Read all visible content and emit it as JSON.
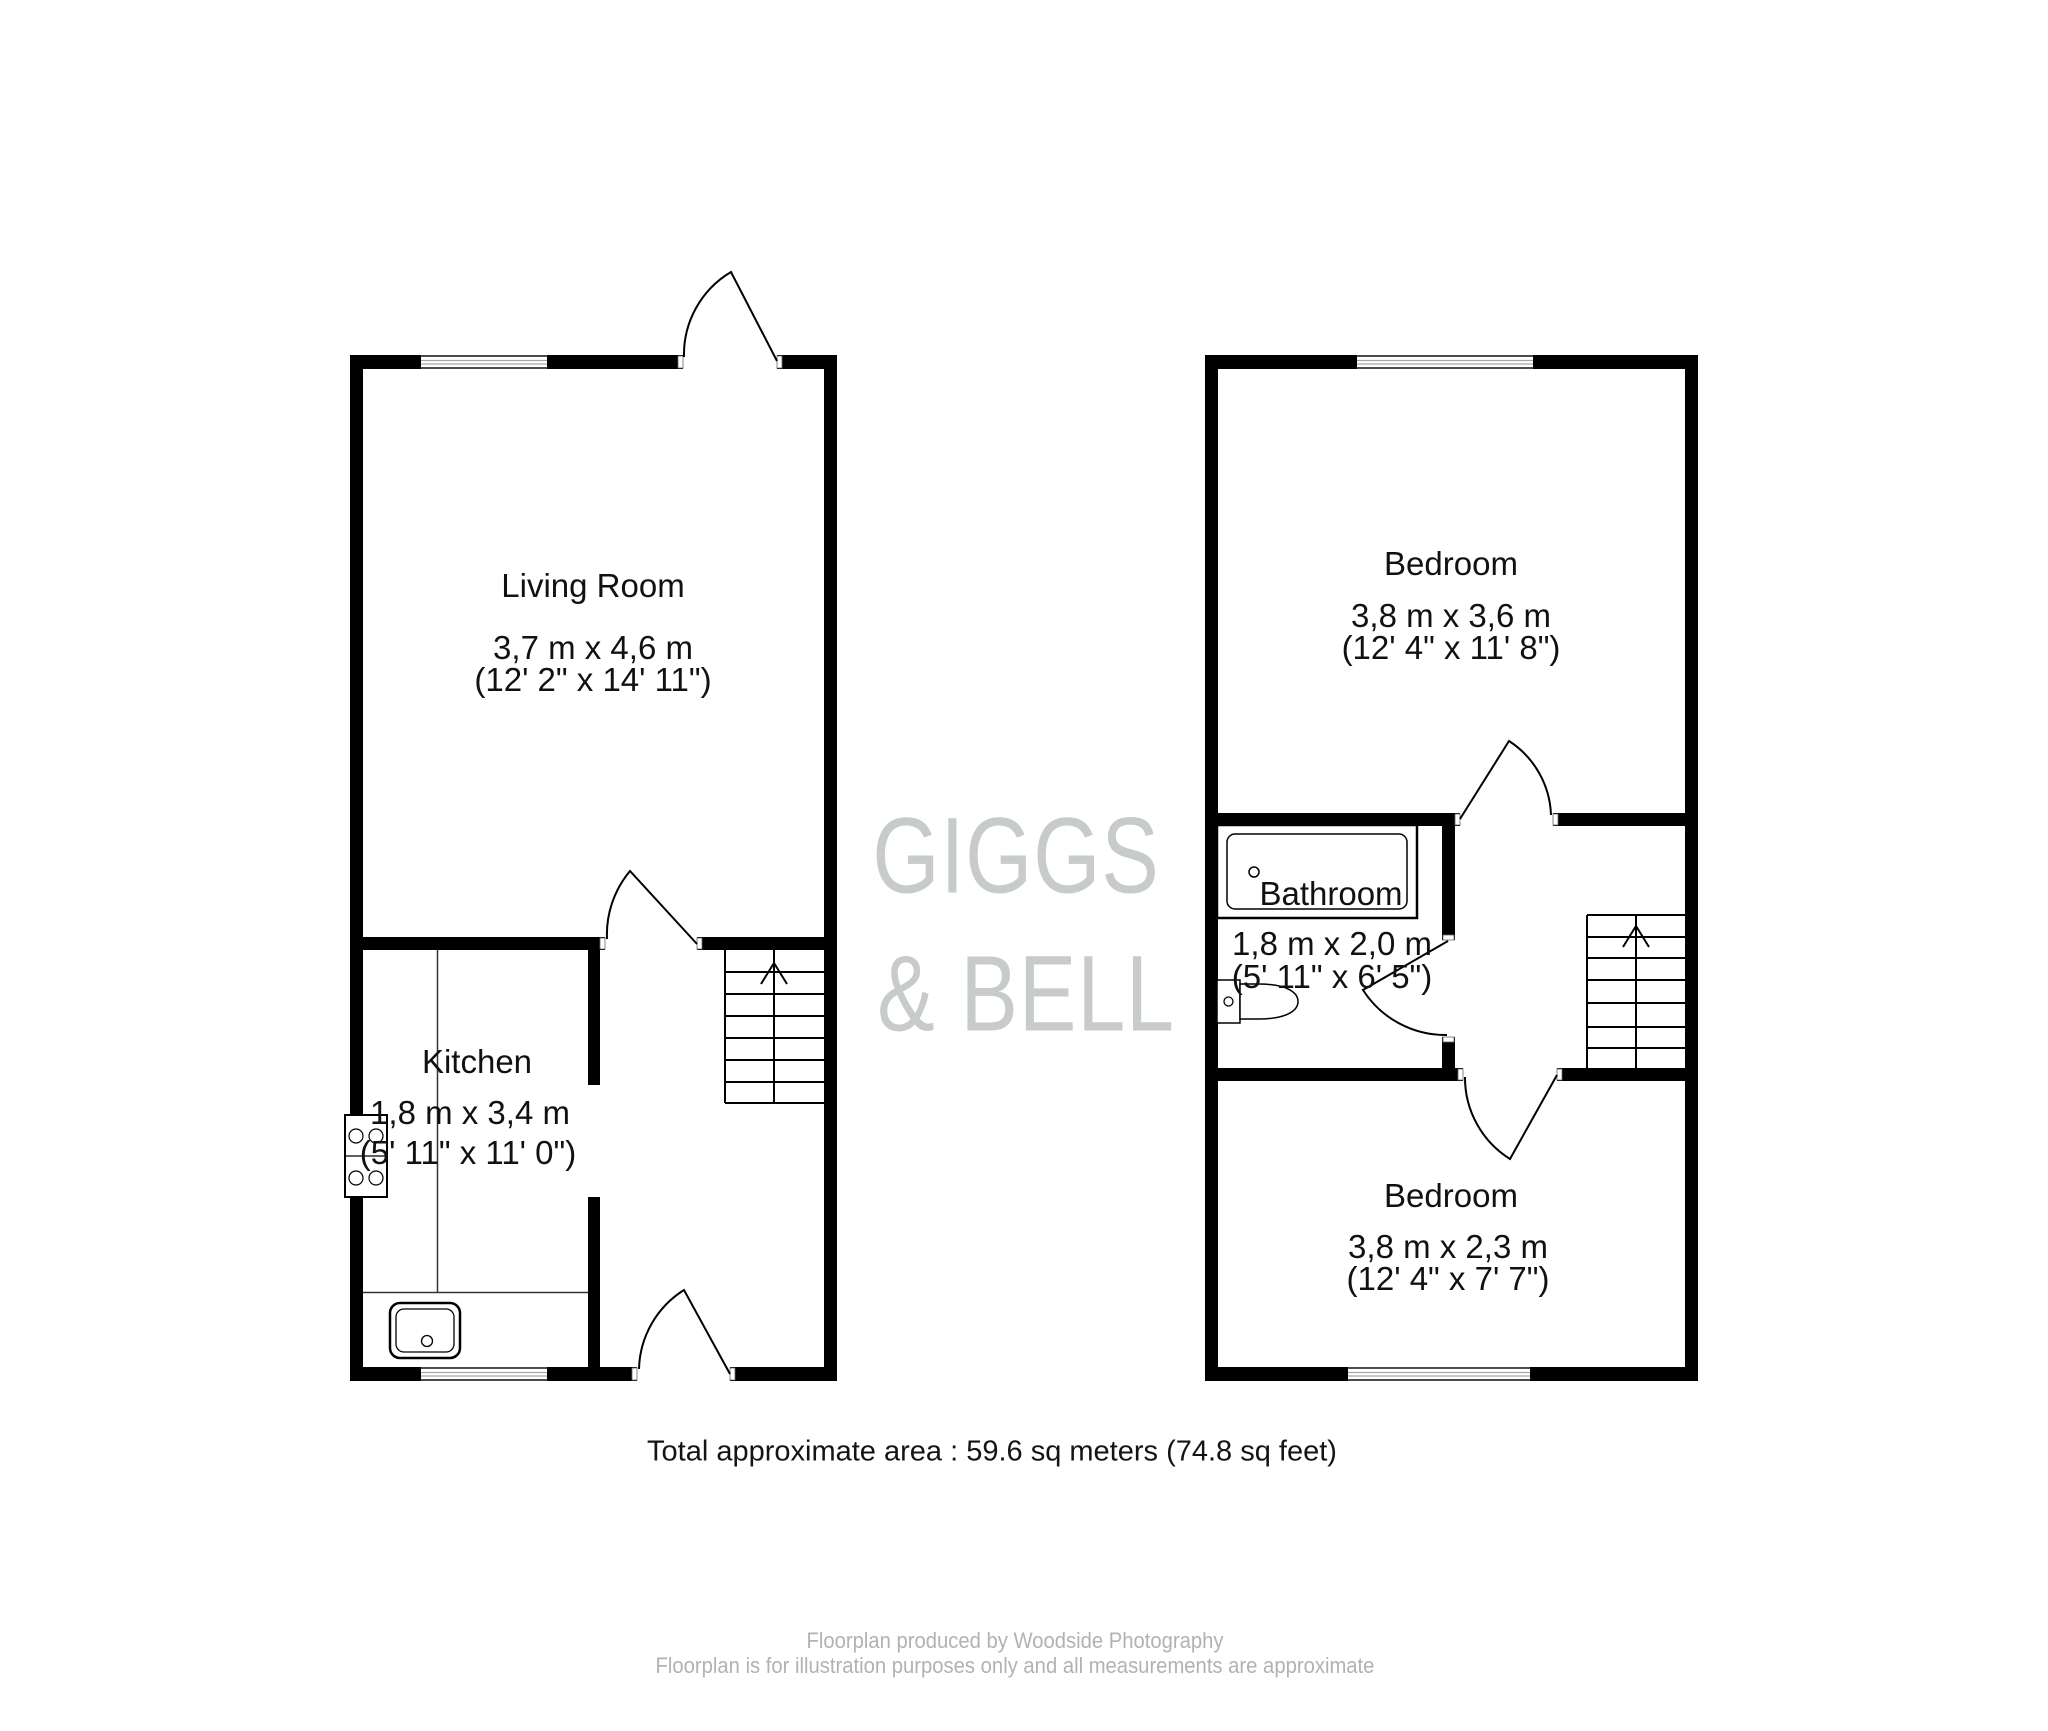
{
  "meta": {
    "background_color": "#ffffff",
    "wall_color": "#000000",
    "watermark_color": "#c8cbcb",
    "footer_color": "#b2b2b2"
  },
  "watermark": {
    "line1": "GIGGS",
    "line2": "& BELL"
  },
  "floors": {
    "ground": {
      "living_room": {
        "name": "Living Room",
        "metric": "3,7 m x 4,6 m",
        "imperial": "(12' 2\" x 14' 11\")"
      },
      "kitchen": {
        "name": "Kitchen",
        "metric": "1,8 m x 3,4 m",
        "imperial": "(5' 11\" x 11' 0\")"
      }
    },
    "first": {
      "bedroom_front": {
        "name": "Bedroom",
        "metric": "3,8 m x 3,6 m",
        "imperial": "(12' 4\" x 11' 8\")"
      },
      "bathroom": {
        "name": "Bathroom",
        "metric": "1,8 m x 2,0 m",
        "imperial": "(5' 11\" x 6' 5\")"
      },
      "bedroom_back": {
        "name": "Bedroom",
        "metric": "3,8 m x 2,3 m",
        "imperial": "(12' 4\" x 7' 7\")"
      }
    }
  },
  "summary": {
    "total_area": "Total approximate area : 59.6 sq meters (74.8 sq feet)"
  },
  "footer": {
    "line1": "Floorplan produced by Woodside Photography",
    "line2": "Floorplan is for illustration purposes only and all measurements are approximate"
  }
}
